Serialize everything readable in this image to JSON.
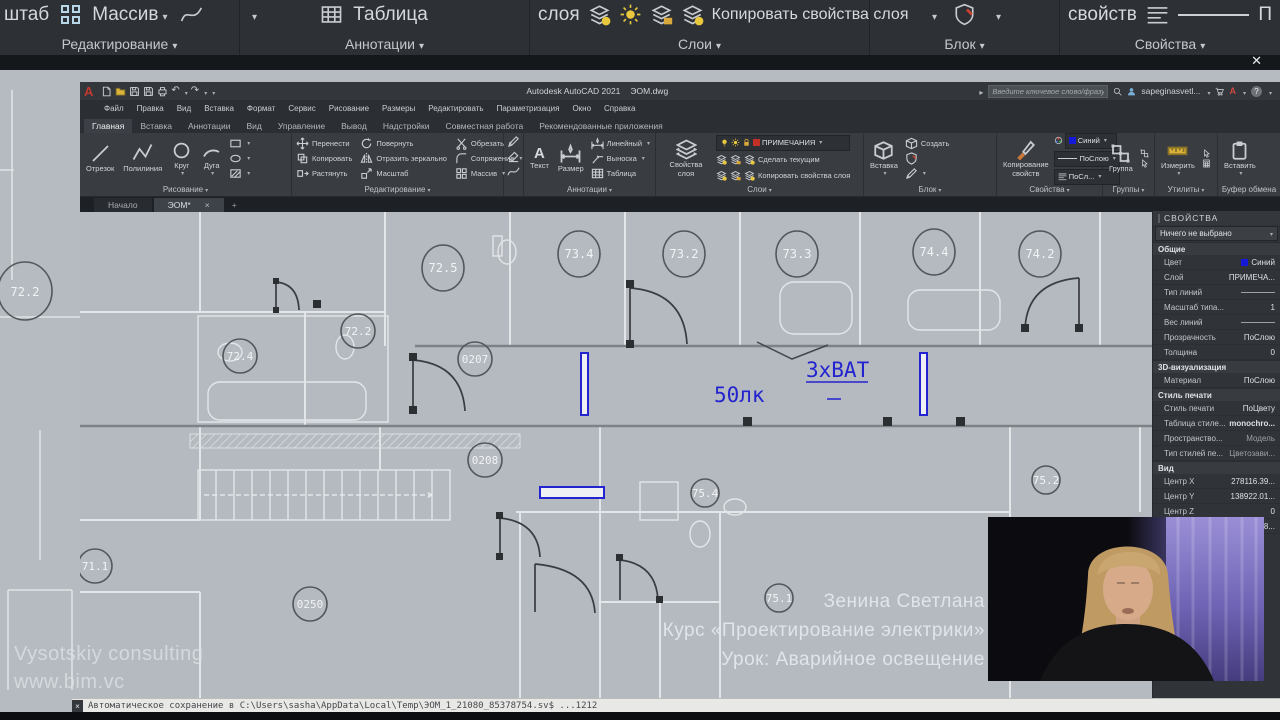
{
  "colors": {
    "annotation_blue": "#2323cf",
    "layer_red": "#c23026",
    "swatch_blue": "#1518d8",
    "accent_yellow": "#e9c83e"
  },
  "zoom_bar": {
    "scale_partial": "штаб",
    "array": "Массив",
    "table": "Таблица",
    "layer_word": "слоя",
    "copy_layer_props": "Копировать свойства слоя",
    "props_word": "свойств",
    "linetype_partial": "П",
    "labels": {
      "editing": "Редактирование",
      "annotations": "Аннотации",
      "layers": "Слои",
      "block": "Блок",
      "properties": "Свойства"
    }
  },
  "titlebar": {
    "logo": "A",
    "app": "Autodesk AutoCAD 2021",
    "file": "ЭОМ.dwg",
    "search_placeholder": "Введите ключевое слово/фразу",
    "user": "sapeginasvetl...",
    "help": "?",
    "autodesk_badge": "A"
  },
  "menubar": {
    "items": [
      "Файл",
      "Правка",
      "Вид",
      "Вставка",
      "Формат",
      "Сервис",
      "Рисование",
      "Размеры",
      "Редактировать",
      "Параметризация",
      "Окно",
      "Справка"
    ]
  },
  "ribbon": {
    "tabs": [
      "Главная",
      "Вставка",
      "Аннотации",
      "Вид",
      "Управление",
      "Вывод",
      "Надстройки",
      "Совместная работа",
      "Рекомендованные приложения"
    ],
    "draw": {
      "label": "Рисование",
      "line": "Отрезок",
      "pline": "Полилиния",
      "circle": "Круг",
      "arc": "Дуга"
    },
    "edit": {
      "label": "Редактирование",
      "move": "Перенести",
      "copy": "Копировать",
      "stretch": "Растянуть",
      "rotate": "Повернуть",
      "mirror": "Отразить зеркально",
      "scale": "Масштаб",
      "trim": "Обрезать",
      "fillet": "Сопряжение",
      "array": "Массив"
    },
    "annot": {
      "label": "Аннотации",
      "text": "Текст",
      "text_icon": "A",
      "dim": "Размер",
      "linear": "Линейный",
      "leader": "Выноска",
      "table": "Таблица"
    },
    "layers": {
      "label": "Слои",
      "props": "Свойства слоя",
      "current": "ПРИМЕЧАНИЯ",
      "make_current": "Сделать текущим",
      "copy_props": "Копировать свойства слоя"
    },
    "block": {
      "label": "Блок",
      "insert": "Вставка",
      "create": "Создать"
    },
    "props": {
      "label": "Свойства",
      "copy": "Копирование свойств",
      "color": "Синий",
      "bylayer": "ПоСлою",
      "bylayer2": "ПоСл..."
    },
    "groups": {
      "label": "Группы",
      "group": "Группа"
    },
    "utils": {
      "label": "Утилиты",
      "measure": "Измерить"
    },
    "clipboard": {
      "label": "Буфер обмена",
      "paste": "Вставить"
    }
  },
  "file_tabs": {
    "start": "Начало",
    "active": "ЭОМ*",
    "close": "×",
    "add": "+"
  },
  "properties_panel": {
    "title": "СВОЙСТВА",
    "selection": "Ничего не выбрано",
    "sections": [
      {
        "name": "Общие",
        "rows": [
          {
            "label": "Цвет",
            "value": "Синий"
          },
          {
            "label": "Слой",
            "value": "ПРИМЕЧА..."
          },
          {
            "label": "Тип линий",
            "value": ""
          },
          {
            "label": "Масштаб типа...",
            "value": "1"
          },
          {
            "label": "Вес линий",
            "value": ""
          },
          {
            "label": "Прозрачность",
            "value": "ПоСлою"
          },
          {
            "label": "Толщина",
            "value": "0"
          }
        ]
      },
      {
        "name": "3D-визуализация",
        "rows": [
          {
            "label": "Материал",
            "value": "ПоСлою"
          }
        ]
      },
      {
        "name": "Стиль печати",
        "rows": [
          {
            "label": "Стиль печати",
            "value": "ПоЦвету"
          },
          {
            "label": "Таблица стиле...",
            "value": "monochro..."
          },
          {
            "label": "Пространство...",
            "value": "Модель"
          },
          {
            "label": "Тип стилей пе...",
            "value": "Цветозави..."
          }
        ]
      },
      {
        "name": "Вид",
        "rows": [
          {
            "label": "Центр X",
            "value": "278116.39..."
          },
          {
            "label": "Центр Y",
            "value": "138922.01..."
          },
          {
            "label": "Центр Z",
            "value": "0"
          },
          {
            "label": "Высота",
            "value": "9245.0148..."
          }
        ]
      }
    ]
  },
  "drawing": {
    "bubbles": [
      "72.2",
      "72.5",
      "73.4",
      "73.2",
      "73.3",
      "74.4",
      "74.2",
      "72.2",
      "72.4",
      "0207",
      "0208",
      "75.4",
      "75.2",
      "71.1",
      "0250",
      "75.1"
    ],
    "lux": "50лк",
    "bat": "3хВАТ"
  },
  "command_bar": {
    "close": "×",
    "text": "Автоматическое сохранение в C:\\Users\\sasha\\AppData\\Local\\Temp\\ЭОМ_1_21080_85378754.sv$ ...1212"
  },
  "overlay": {
    "author": "Зенина Светлана",
    "course": "Курс «Проектирование электрики»",
    "lesson": "Урок: Аварийное освещение",
    "brand": "Vysotskiy consulting",
    "site": "www.bim.vc"
  }
}
